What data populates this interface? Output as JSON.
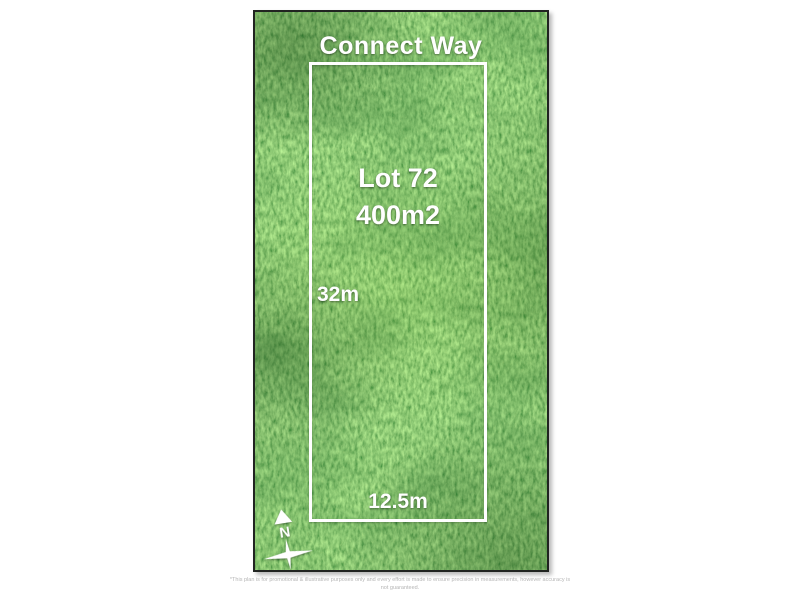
{
  "plan": {
    "street_name": "Connect Way",
    "lot_number": "Lot 72",
    "lot_area": "400m2",
    "depth": "32m",
    "frontage": "12.5m",
    "north_label": "N"
  },
  "disclaimer": {
    "line1": "*This plan is for promotional & illustrative purposes only and every effort is made to ensure precision in measurements, however accuracy is",
    "line2": "not guaranteed."
  },
  "colors": {
    "grass_base": "#3f8c36",
    "grass_dark": "#27632a",
    "grass_light": "#9cc455",
    "boundary_line": "#ffffff",
    "photo_frame": "#212421",
    "label_text": "#ffffff",
    "disclaimer_text": "#b5b5b5",
    "background": "#ffffff"
  }
}
